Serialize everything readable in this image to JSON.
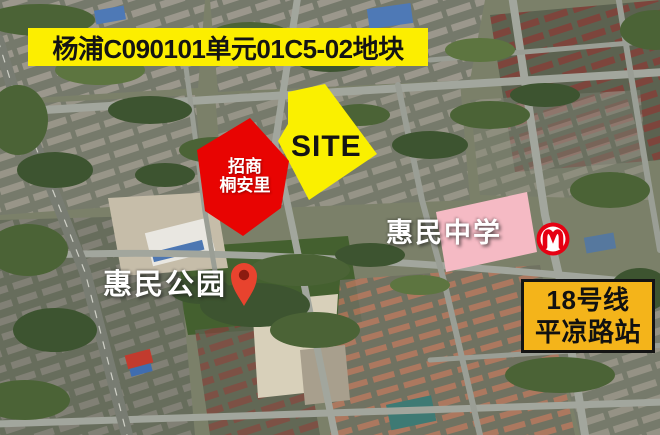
{
  "banner": {
    "text": "杨浦C090101单元01C5-02地块",
    "bg_color": "#FCEE00",
    "text_color": "#141414"
  },
  "parcels": {
    "site": {
      "label": "SITE",
      "fill_color": "#FAF000",
      "label_color": "#141414"
    },
    "project": {
      "line1": "招商",
      "line2": "桐安里",
      "fill_color": "#E80402",
      "label_color": "#FFFFFF"
    },
    "school": {
      "label": "惠民中学",
      "fill_color": "#F5BAC4",
      "label_color": "#FFFFFF"
    }
  },
  "park": {
    "label": "惠民公园",
    "label_color": "#FFFFFF",
    "pin_color": "#E8432E",
    "pin_hole_color": "#8C1B10"
  },
  "metro": {
    "station_line": "18号线",
    "station_name": "平凉路站",
    "box_bg_color": "#F4B41A",
    "box_border_color": "#141414",
    "box_text_color": "#111111",
    "logo_color": "#E60012"
  },
  "icons": {
    "metro_logo": "shanghai-metro-logo",
    "park_pin": "map-pin"
  }
}
